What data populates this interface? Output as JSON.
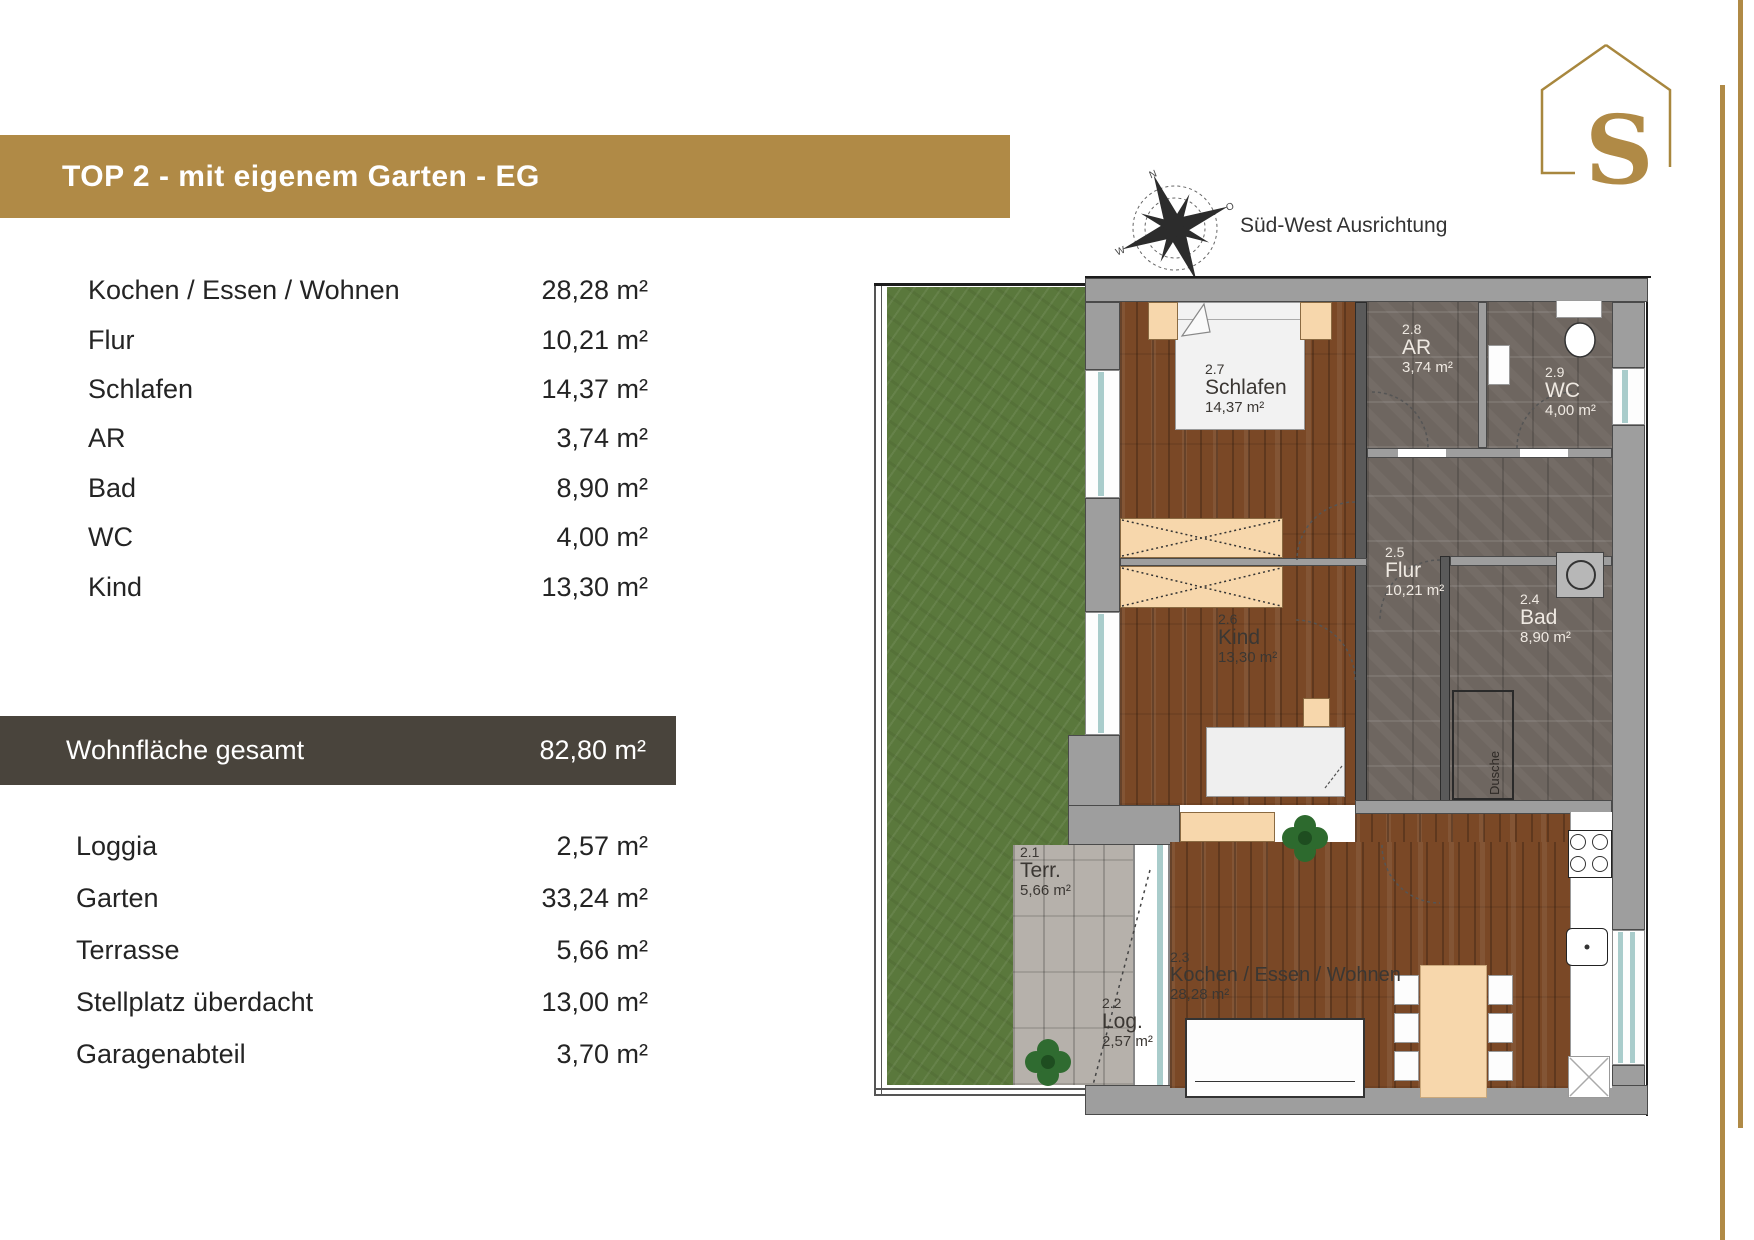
{
  "header": {
    "title": "TOP 2 - mit eigenem Garten - EG"
  },
  "logo": {
    "letter": "S"
  },
  "compass": {
    "label": "Süd-West Ausrichtung"
  },
  "interior_rooms": {
    "rows": [
      {
        "label": "Kochen / Essen / Wohnen",
        "value": "28,28 m²"
      },
      {
        "label": "Flur",
        "value": "10,21 m²"
      },
      {
        "label": "Schlafen",
        "value": "14,37 m²"
      },
      {
        "label": "AR",
        "value": "3,74 m²"
      },
      {
        "label": "Bad",
        "value": "8,90 m²"
      },
      {
        "label": "WC",
        "value": "4,00 m²"
      },
      {
        "label": "Kind",
        "value": "13,30 m²"
      }
    ]
  },
  "total": {
    "label": "Wohnfläche gesamt",
    "value": "82,80 m²"
  },
  "outdoor": {
    "rows": [
      {
        "label": "Loggia",
        "value": "2,57 m²"
      },
      {
        "label": "Garten",
        "value": "33,24 m²"
      },
      {
        "label": "Terrasse",
        "value": "5,66 m²"
      },
      {
        "label": "Stellplatz überdacht",
        "value": "13,00 m²"
      },
      {
        "label": "Garagenabteil",
        "value": "3,70 m²"
      }
    ]
  },
  "floorplan": {
    "labels": [
      {
        "number": "2.7",
        "name": "Schlafen",
        "area": "14,37 m²"
      },
      {
        "number": "2.8",
        "name": "AR",
        "area": "3,74 m²"
      },
      {
        "number": "2.9",
        "name": "WC",
        "area": "4,00 m²"
      },
      {
        "number": "2.5",
        "name": "Flur",
        "area": "10,21 m²"
      },
      {
        "number": "2.4",
        "name": "Bad",
        "area": "8,90 m²"
      },
      {
        "number": "2.6",
        "name": "Kind",
        "area": "13,30 m²"
      },
      {
        "number": "2.3",
        "name": "Kochen / Essen / Wohnen",
        "area": "28,28 m²"
      },
      {
        "number": "2.1",
        "name": "Terr.",
        "area": "5,66 m²"
      },
      {
        "number": "2.2",
        "name": "Log.",
        "area": "2,57 m²"
      }
    ],
    "shower_label": "Dusche"
  },
  "colors": {
    "banner_gold": "#b08a46",
    "total_bar": "#49443c",
    "garden_green": "#5a783c",
    "wood_floor": "#7a4826",
    "tile_floor": "#6e6660",
    "paving": "#b6b1ab",
    "wall_gray": "#9e9e9e",
    "furniture_peach": "#f7d7ac",
    "window_glass": "#a9cccb"
  }
}
